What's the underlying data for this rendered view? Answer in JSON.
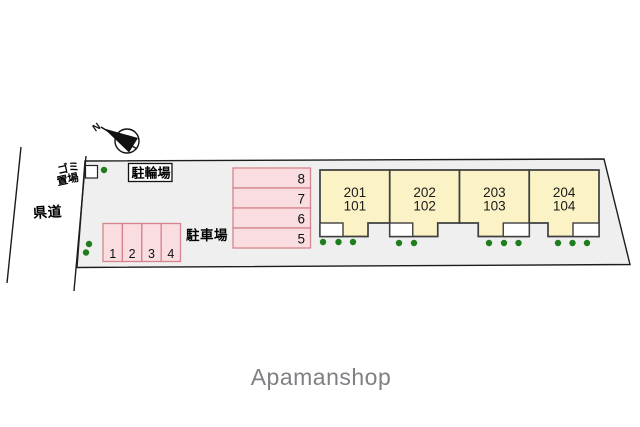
{
  "diagram": {
    "road_label": "県道",
    "garbage_area": {
      "line1": "ゴミ",
      "line2": "置場"
    },
    "bicycle_parking_label": "駐輪場",
    "parking_label": "駐車場",
    "compass": {
      "north_label": "N"
    }
  },
  "parking_row_west": {
    "stalls": [
      "1",
      "2",
      "3",
      "4"
    ]
  },
  "parking_column_center": {
    "stalls": [
      "8",
      "7",
      "6",
      "5"
    ]
  },
  "building": {
    "units": [
      {
        "upper": "201",
        "lower": "101"
      },
      {
        "upper": "202",
        "lower": "102"
      },
      {
        "upper": "203",
        "lower": "103"
      },
      {
        "upper": "204",
        "lower": "104"
      }
    ]
  },
  "watermark": "Apamanshop",
  "colors": {
    "site_fill": "#efefef",
    "line_black": "#1c1c1c",
    "stall_fill": "#f9dde0",
    "stall_border": "#d5848d",
    "building_fill": "#fbf3c6",
    "building_border": "#3f3f3f",
    "plant_green": "#1f7d1f",
    "watermark_gray": "#7f8084"
  }
}
